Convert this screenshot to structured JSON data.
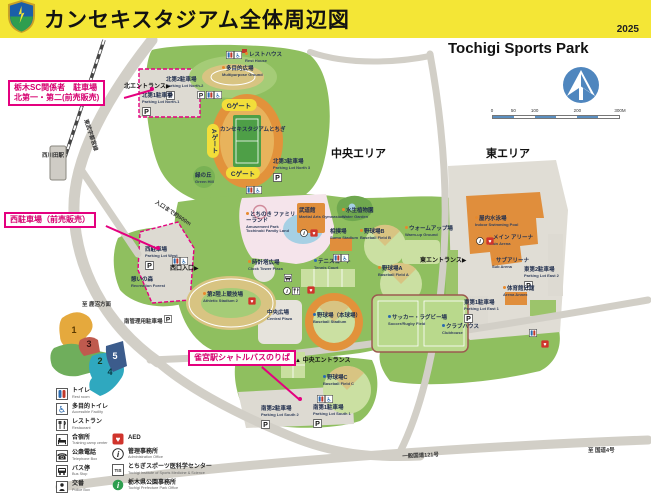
{
  "header": {
    "title": "カンセキスタジアム全体周辺図",
    "year": "2025",
    "logo": "tochigi-sc-crest"
  },
  "map": {
    "title_en": "Tochigi Sports Park",
    "scale_ticks": [
      "0",
      "50",
      "100",
      "200",
      "300M"
    ],
    "area_labels": [
      {
        "text": "中央エリア",
        "x": 331,
        "y": 145
      },
      {
        "text": "東エリア",
        "x": 486,
        "y": 145
      }
    ],
    "gates": [
      {
        "label": "Gゲート",
        "x": 239,
        "y": 105,
        "vertical": false
      },
      {
        "label": "Aゲート",
        "x": 213,
        "y": 141,
        "vertical": true
      },
      {
        "label": "Cゲート",
        "x": 243,
        "y": 173,
        "vertical": false
      }
    ],
    "entrances": [
      {
        "label": "北エントランス",
        "x": 124,
        "y": 81,
        "arrow": "▶",
        "arrow_pos": "after"
      },
      {
        "label": "西口入口",
        "x": 170,
        "y": 263,
        "arrow": "▶",
        "arrow_pos": "after"
      },
      {
        "label": "東エントランス",
        "x": 420,
        "y": 255,
        "arrow": "▶",
        "arrow_pos": "after"
      },
      {
        "label": "中央エントランス",
        "x": 295,
        "y": 355,
        "arrow": "▲",
        "arrow_pos": "before"
      }
    ],
    "labels": [
      {
        "jp": "レストハウス",
        "en": "Rest House",
        "x": 245,
        "y": 52,
        "bullet": "#E8892C"
      },
      {
        "jp": "多目的広場",
        "en": "Multipurpose Ground",
        "x": 222,
        "y": 66,
        "bullet": "#E8892C"
      },
      {
        "jp": "北第2駐車場",
        "en": "Parking Lot North-2",
        "x": 166,
        "y": 78,
        "parking": true
      },
      {
        "jp": "北第1駐車場",
        "en": "Parking Lot North-1",
        "x": 142,
        "y": 94,
        "parking": true
      },
      {
        "jp": "カンセキスタジアムとちぎ",
        "en": "",
        "x": 220,
        "y": 128
      },
      {
        "jp": "緑の丘",
        "en": "Green Hill",
        "x": 195,
        "y": 174
      },
      {
        "jp": "北第3駐車場",
        "en": "Parking Lot North 3",
        "x": 273,
        "y": 160,
        "parking": true
      },
      {
        "jp": "とちのき ファミリーランド",
        "en": "Amusement Park Tochinoki Family Land",
        "x": 246,
        "y": 212,
        "bullet": "#E8892C",
        "wrap": true
      },
      {
        "jp": "武道館",
        "en": "Martial Arts Gymnasium",
        "x": 299,
        "y": 209
      },
      {
        "jp": "相撲場",
        "en": "Sumo Stadium",
        "x": 330,
        "y": 230
      },
      {
        "jp": "時計塔広場",
        "en": "Clock Tower Plaza",
        "x": 248,
        "y": 260,
        "bullet": "#E8892C"
      },
      {
        "jp": "テニスコート",
        "en": "Tennis Court",
        "x": 314,
        "y": 259,
        "bullet": "#2B6BB0"
      },
      {
        "jp": "第2陸上競技場",
        "en": "Athletic Stadium 2",
        "x": 203,
        "y": 292,
        "bullet": "#E8892C"
      },
      {
        "jp": "中央広場",
        "en": "Central Plaza",
        "x": 267,
        "y": 311
      },
      {
        "jp": "水生植物園",
        "en": "Water Garden",
        "x": 342,
        "y": 208,
        "bullet": "#E8892C"
      },
      {
        "jp": "野球場B",
        "en": "Baseball Field B",
        "x": 360,
        "y": 229,
        "bullet": "#E8892C"
      },
      {
        "jp": "ウォームアップ場",
        "en": "Warm-up Ground",
        "x": 405,
        "y": 226,
        "bullet": "#E8892C"
      },
      {
        "jp": "野球場A",
        "en": "Baseball Field A",
        "x": 378,
        "y": 266,
        "bullet": "#E8892C"
      },
      {
        "jp": "野球場（本球場）",
        "en": "Baseball Stadium",
        "x": 313,
        "y": 313,
        "bullet": "#2B6BB0"
      },
      {
        "jp": "サッカー・ラグビー場",
        "en": "Soccer/Rugby Field",
        "x": 388,
        "y": 315,
        "bullet": "#2B6BB0"
      },
      {
        "jp": "クラブハウス",
        "en": "Clubhouse",
        "x": 442,
        "y": 324,
        "bullet": "#2B6BB0"
      },
      {
        "jp": "野球場C",
        "en": "Baseball Field C",
        "x": 323,
        "y": 375,
        "bullet": "#2B6BB0"
      },
      {
        "jp": "南第2駐車場",
        "en": "Parking Lot South 2",
        "x": 261,
        "y": 407,
        "parking": true
      },
      {
        "jp": "南第1駐車場",
        "en": "Parking Lot South 1",
        "x": 313,
        "y": 406,
        "parking": true
      },
      {
        "jp": "屋内水泳場",
        "en": "Indoor Swimming Pool",
        "x": 475,
        "y": 216,
        "bullet": "#E8892C"
      },
      {
        "jp": "メイン アリーナ",
        "en": "Main Arena",
        "x": 489,
        "y": 235,
        "bullet": "#E8892C"
      },
      {
        "jp": "サブアリーナ",
        "en": "Sub Arena",
        "x": 492,
        "y": 258,
        "bullet": "#E8892C"
      },
      {
        "jp": "東第2駐車場",
        "en": "Parking Lot East 2",
        "x": 524,
        "y": 268,
        "parking": true
      },
      {
        "jp": "体育館分館",
        "en": "Arena Annex",
        "x": 503,
        "y": 286,
        "bullet": "#E8892C"
      },
      {
        "jp": "東第1駐車場",
        "en": "Parking Lot East 1",
        "x": 464,
        "y": 301,
        "parking": true
      },
      {
        "jp": "西駐車場",
        "en": "Parking Lot West",
        "x": 145,
        "y": 248,
        "parking": true
      },
      {
        "jp": "憩いの森",
        "en": "Recreation Forest",
        "x": 131,
        "y": 278
      }
    ],
    "road_labels": [
      {
        "text": "東武宇都宮線",
        "x": 90,
        "y": 118,
        "rot": 72
      },
      {
        "text": "西川田駅",
        "x": 42,
        "y": 151,
        "rot": 0
      },
      {
        "text": "入口まで約600m",
        "x": 158,
        "y": 198,
        "rot": 33
      },
      {
        "text": "至 鹿沼方面",
        "x": 82,
        "y": 300,
        "rot": 0
      },
      {
        "text": "南管理用駐車場",
        "x": 124,
        "y": 315,
        "rot": 0,
        "parking": true
      },
      {
        "text": "一般国道121号",
        "x": 402,
        "y": 452,
        "rot": -3
      },
      {
        "text": "至 国道4号",
        "x": 588,
        "y": 446,
        "rot": 0
      }
    ],
    "callouts": [
      {
        "lines": [
          "栃木SC関係者　駐車場",
          "北第一・第二(前売販売)"
        ],
        "x": 8,
        "y": 80,
        "leader": {
          "x1": 124,
          "y1": 97,
          "x2": 152,
          "y2": 89
        }
      },
      {
        "lines": [
          "西駐車場（前売販売）"
        ],
        "x": 4,
        "y": 212,
        "leader": {
          "x1": 106,
          "y1": 225,
          "x2": 158,
          "y2": 248
        }
      },
      {
        "lines": [
          "雀宮駅シャトルバスのりば"
        ],
        "x": 188,
        "y": 350,
        "leader": {
          "x1": 262,
          "y1": 366,
          "x2": 300,
          "y2": 399
        }
      }
    ],
    "zones": [
      {
        "n": "1",
        "x": 74,
        "y": 330,
        "color": "#5A3A00"
      },
      {
        "n": "2",
        "x": 100,
        "y": 361,
        "color": "#17381A"
      },
      {
        "n": "3",
        "x": 89,
        "y": 344,
        "color": "#3A1210"
      },
      {
        "n": "4",
        "x": 110,
        "y": 372,
        "color": "#073B46"
      },
      {
        "n": "5",
        "x": 115,
        "y": 356,
        "color": "#FFFFFF"
      }
    ],
    "icons": [
      {
        "type": "restroom-icon",
        "x": 226,
        "y": 51
      },
      {
        "type": "accessible-icon",
        "x": 234,
        "y": 51
      },
      {
        "type": "parking-icon",
        "x": 197,
        "y": 91
      },
      {
        "type": "restroom-icon",
        "x": 206,
        "y": 91
      },
      {
        "type": "accessible-icon",
        "x": 214,
        "y": 91
      },
      {
        "type": "restroom-icon",
        "x": 246,
        "y": 186
      },
      {
        "type": "accessible-icon",
        "x": 254,
        "y": 186
      },
      {
        "type": "info-icon",
        "x": 300,
        "y": 229
      },
      {
        "type": "aed-icon",
        "x": 310,
        "y": 229
      },
      {
        "type": "restroom-icon",
        "x": 333,
        "y": 254
      },
      {
        "type": "accessible-icon",
        "x": 341,
        "y": 254
      },
      {
        "type": "bus-stop-icon",
        "x": 284,
        "y": 274
      },
      {
        "type": "info-icon",
        "x": 283,
        "y": 287
      },
      {
        "type": "restaurant-icon",
        "x": 292,
        "y": 287
      },
      {
        "type": "aed-icon",
        "x": 248,
        "y": 297
      },
      {
        "type": "aed-icon",
        "x": 307,
        "y": 286
      },
      {
        "type": "restroom-icon",
        "x": 317,
        "y": 395
      },
      {
        "type": "accessible-icon",
        "x": 325,
        "y": 395
      },
      {
        "type": "restroom-icon",
        "x": 529,
        "y": 329
      },
      {
        "type": "aed-icon",
        "x": 541,
        "y": 340
      },
      {
        "type": "info-icon",
        "x": 476,
        "y": 237
      },
      {
        "type": "aed-icon",
        "x": 486,
        "y": 237
      },
      {
        "type": "restroom-icon",
        "x": 172,
        "y": 257
      },
      {
        "type": "accessible-icon",
        "x": 180,
        "y": 257
      }
    ]
  },
  "legend": {
    "left": [
      {
        "icon": "restroom-icon",
        "jp": "トイレ",
        "en": "Rest room"
      },
      {
        "icon": "accessible-icon",
        "jp": "多目的トイレ",
        "en": "Accessible Facility"
      },
      {
        "icon": "restaurant-icon",
        "jp": "レストラン",
        "en": "Restaurant"
      },
      {
        "icon": "lodging-icon",
        "jp": "合宿所",
        "en": "Training camp center"
      },
      {
        "icon": "phone-icon",
        "jp": "公衆電話",
        "en": "Telephone Box"
      },
      {
        "icon": "bus-stop-icon",
        "jp": "バス停",
        "en": "Bus Stop"
      },
      {
        "icon": "police-icon",
        "jp": "交番",
        "en": "Police Box"
      }
    ],
    "right": [
      {
        "icon": "aed-icon",
        "jp": "AED",
        "en": ""
      },
      {
        "icon": "info-icon",
        "jp": "管理事務所",
        "en": "Administration Office"
      },
      {
        "icon": "tis-icon",
        "jp": "とちぎスポーツ医科学センター",
        "en": "Tochigi Institute of Sports Medicine & Science"
      },
      {
        "icon": "park-office-icon",
        "jp": "栃木県公園事務所",
        "en": "Tochigi Prefecture Park Office"
      }
    ]
  }
}
